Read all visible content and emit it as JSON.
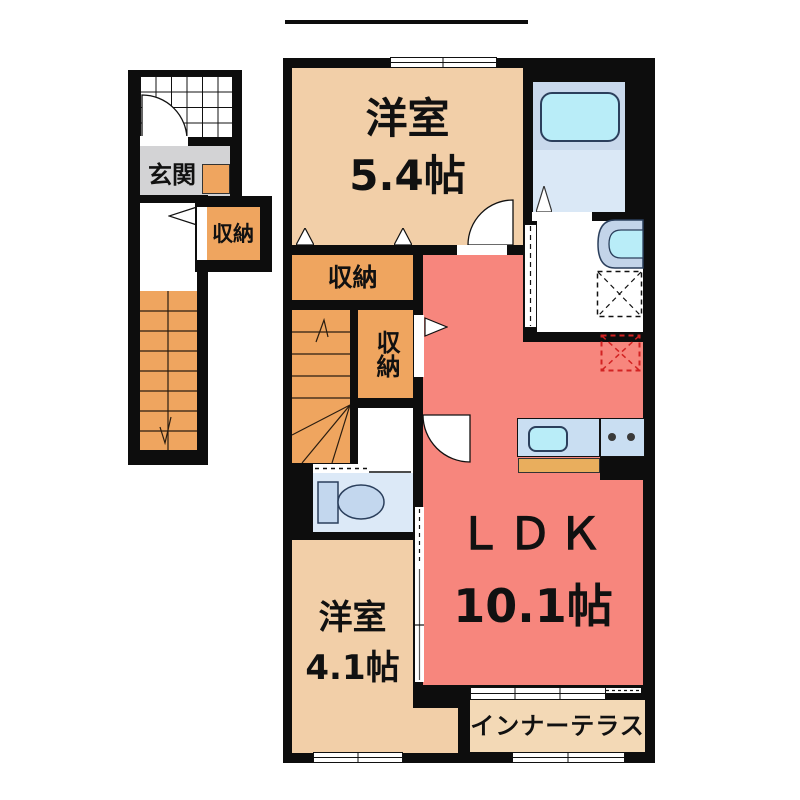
{
  "floor_plan": {
    "entrance": {
      "label": "玄関"
    },
    "entrance_closet": {
      "label": "収納"
    },
    "bedroom_upper": {
      "name": "洋室",
      "size": "5.4帖"
    },
    "closet_upper": {
      "label": "収納"
    },
    "closet_mid": {
      "label": "収納"
    },
    "bedroom_lower": {
      "name": "洋室",
      "size": "4.1帖"
    },
    "ldk": {
      "name": "ＬＤＫ",
      "size": "10.1帖"
    },
    "inner_terrace": {
      "label": "インナーテラス"
    }
  },
  "colors": {
    "wall": "#0d0d0d",
    "room_beige": "#f2cfa8",
    "ldk_salmon": "#f7867d",
    "storage_orange": "#efa55f",
    "terrace_beige": "#f3d9b6",
    "entrance_gray": "#d3d3d5",
    "bath_blue": "#c9d9ec",
    "bath_lower_blue": "#dae8f6",
    "tub_cyan": "#b9edf8",
    "toilet_room_blue": "#dce9f7",
    "fixture_blue": "#c3d7ee",
    "kitchen_blue": "#c9def2",
    "counter_orange": "#e9ae5d",
    "fridge_dashed_red": "#d22222"
  }
}
